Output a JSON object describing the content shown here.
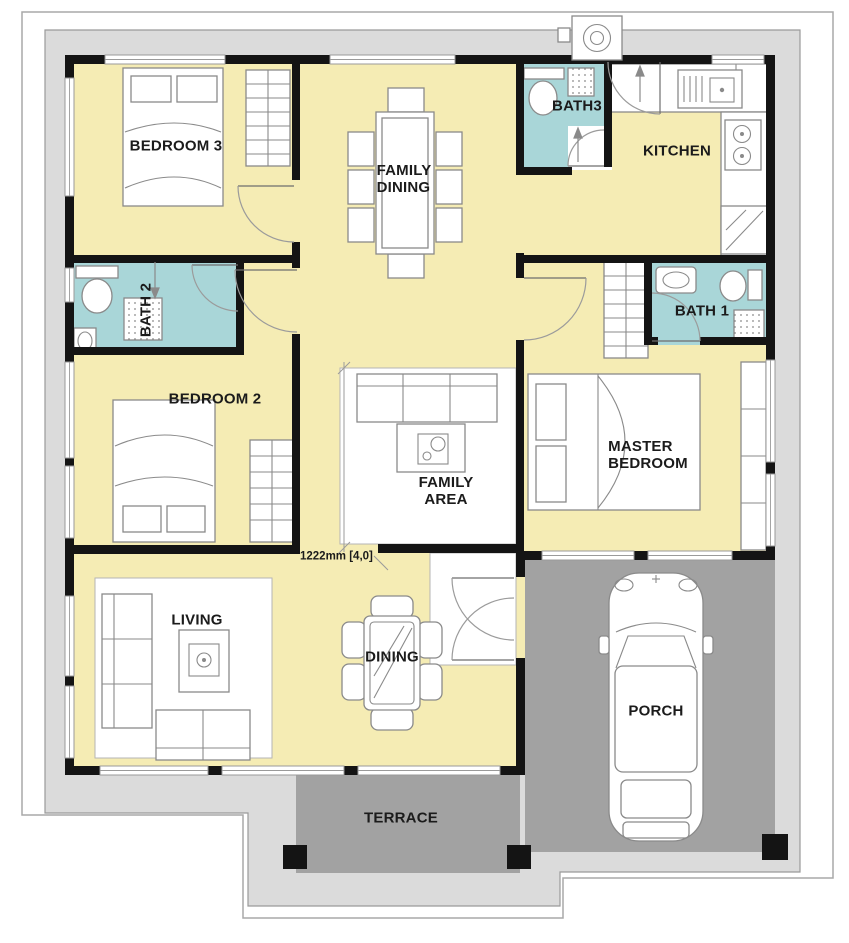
{
  "labels": {
    "bedroom3": "BEDROOM 3",
    "family_dining_line1": "FAMILY",
    "family_dining_line2": "DINING",
    "bath3": "BATH3",
    "kitchen": "KITCHEN",
    "bath2": "BATH 2",
    "bedroom2": "BEDROOM 2",
    "family_area_line1": "FAMILY",
    "family_area_line2": "AREA",
    "bath1": "BATH 1",
    "master_line1": "MASTER",
    "master_line2": "BEDROOM",
    "living": "LIVING",
    "dining": "DINING",
    "porch": "PORCH",
    "terrace": "TERRACE",
    "dimension": "1222mm [4,0]"
  },
  "colors": {
    "room_yellow": "#f5ecb4",
    "bath_teal": "#a9d6d8",
    "porch_gray": "#a2a2a2",
    "apron_gray": "#dbdbdb",
    "wall_black": "#141414",
    "furniture_line": "#8a8a8a"
  },
  "icons": [
    "bed-icon",
    "wardrobe-icon",
    "sofa-icon",
    "coffee-table-icon",
    "dining-table-icon",
    "chair-icon",
    "toilet-icon",
    "sink-icon",
    "shower-icon",
    "stove-icon",
    "kitchen-sink-icon",
    "fridge-icon",
    "exhaust-fan-icon",
    "car-icon",
    "door-swing-icon",
    "window-icon",
    "column-icon"
  ]
}
